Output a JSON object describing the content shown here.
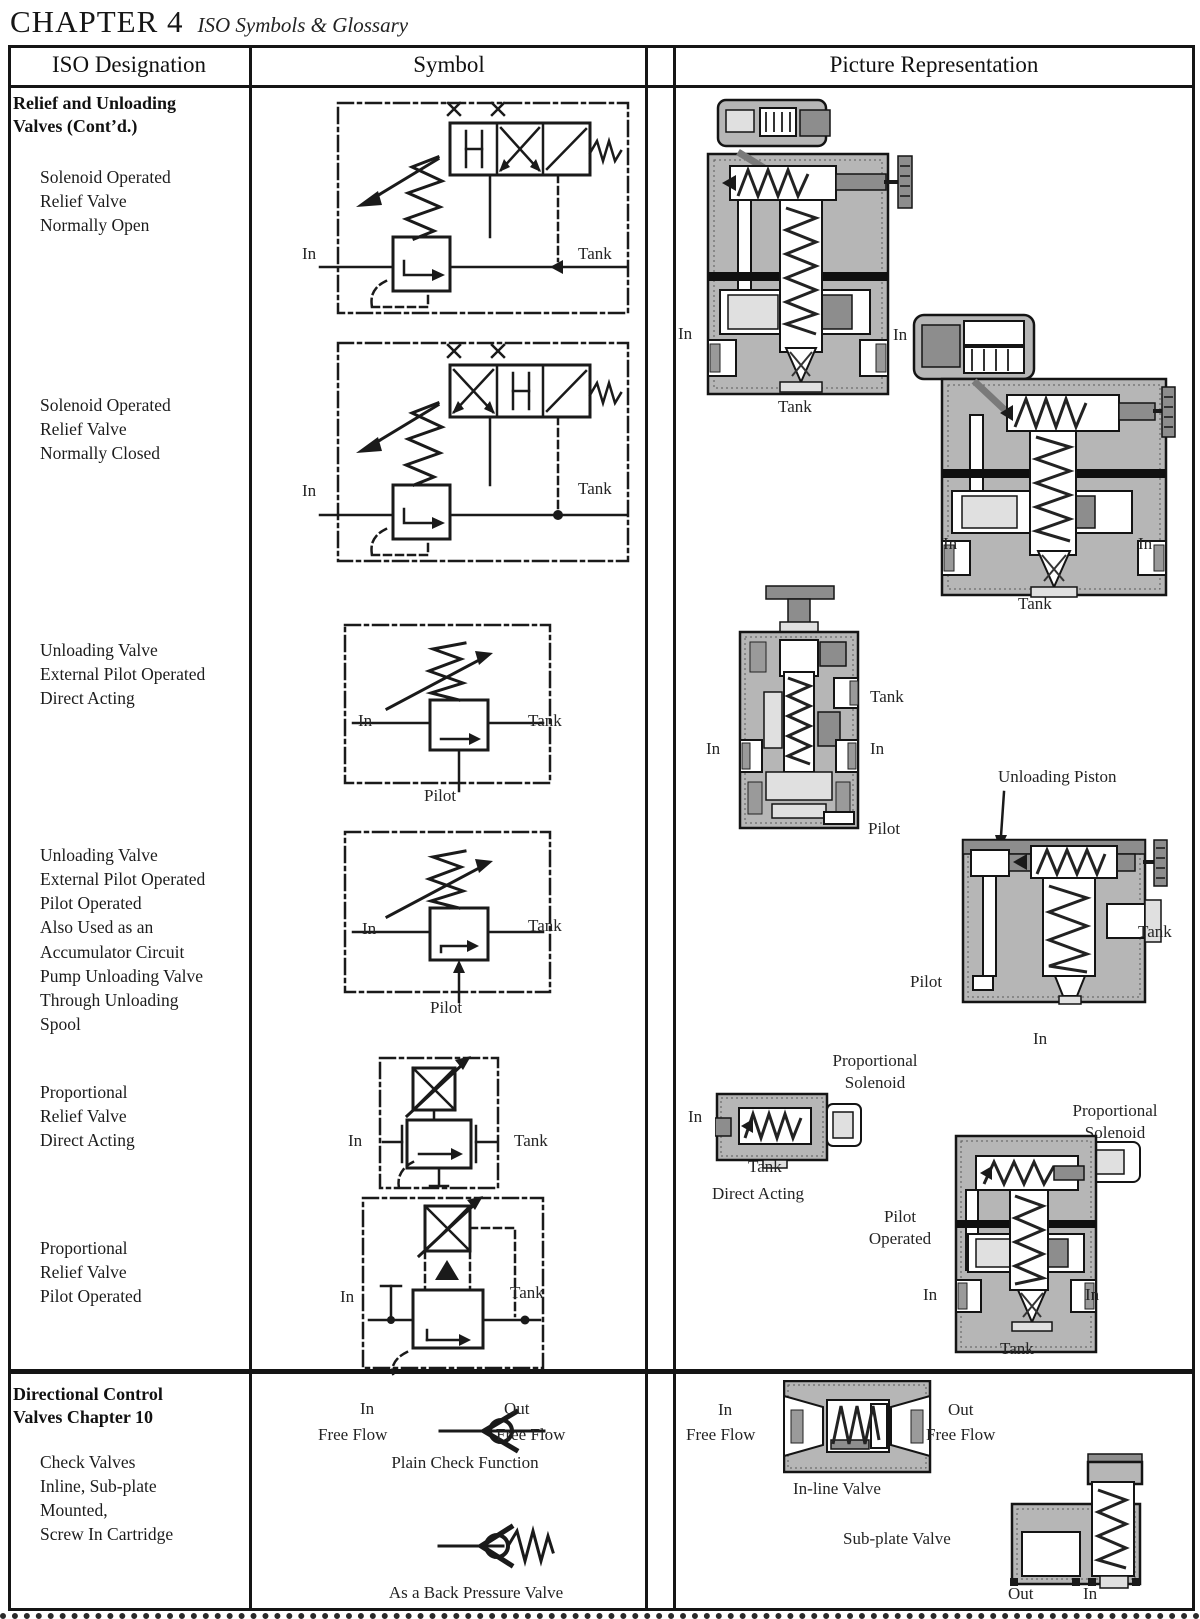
{
  "header": {
    "chapter": "CHAPTER 4",
    "subtitle": "ISO Symbols & Glossary"
  },
  "table": {
    "col1": "ISO Designation",
    "col2": "Symbol",
    "col3": "Picture Representation"
  },
  "designations": {
    "section1": "Relief and Unloading\nValves (Cont’d.)",
    "d1": "Solenoid Operated\nRelief Valve\nNormally Open",
    "d2": "Solenoid Operated\nRelief Valve\nNormally Closed",
    "d3": "Unloading Valve\nExternal Pilot Operated\nDirect Acting",
    "d4": "Unloading Valve\nExternal Pilot Operated\nPilot Operated\nAlso Used as an\nAccumulator Circuit\nPump Unloading Valve\nThrough Unloading\nSpool",
    "d5": "Proportional\nRelief Valve\nDirect Acting",
    "d6": "Proportional\nRelief Valve\nPilot Operated",
    "section2": "Directional Control\nValves Chapter 10",
    "d7": "Check Valves\nInline, Sub-plate\nMounted,\nScrew In Cartridge"
  },
  "symbols": {
    "s1": {
      "in": "In",
      "tank": "Tank"
    },
    "s2": {
      "in": "In",
      "tank": "Tank"
    },
    "s3": {
      "in": "In",
      "tank": "Tank",
      "pilot": "Pilot"
    },
    "s4": {
      "in": "In",
      "tank": "Tank",
      "pilot": "Pilot"
    },
    "s5": {
      "in": "In",
      "tank": "Tank"
    },
    "s6": {
      "in": "In",
      "tank": "Tank"
    },
    "check": {
      "in_top": "In",
      "in_bottom": "Free Flow",
      "out_top": "Out",
      "out_bottom": "Free Flow",
      "caption": "Plain Check Function",
      "back_caption": "As a Back Pressure Valve"
    }
  },
  "pictures": {
    "p1": {
      "in_left": "In",
      "tank": "Tank"
    },
    "p2": {
      "in_top": "In",
      "in_left": "In",
      "in_right": "In",
      "tank": "Tank"
    },
    "p3": {
      "tank": "Tank",
      "in_left": "In",
      "in_right": "In",
      "pilot": "Pilot"
    },
    "p4": {
      "callout": "Unloading Piston",
      "tank": "Tank",
      "pilot": "Pilot",
      "in": "In"
    },
    "p5": {
      "callout": "Proportional\nSolenoid",
      "in": "In",
      "tank": "Tank",
      "caption": "Direct Acting"
    },
    "p6": {
      "callout": "Proportional\nSolenoid",
      "caption": "Pilot\nOperated",
      "in_left": "In",
      "in_right": "In",
      "tank": "Tank"
    },
    "p7": {
      "in_top": "In",
      "in_bottom": "Free Flow",
      "out_top": "Out",
      "out_bottom": "Free Flow",
      "caption": "In-line Valve"
    },
    "p8": {
      "caption": "Sub-plate Valve",
      "out": "Out",
      "in": "In"
    }
  },
  "colors": {
    "ink": "#1a1a1a",
    "paper": "#ffffff",
    "gray_body": "#b6b6b6",
    "gray_light": "#e0e0e0",
    "gray_dark": "#8d8d8d"
  }
}
